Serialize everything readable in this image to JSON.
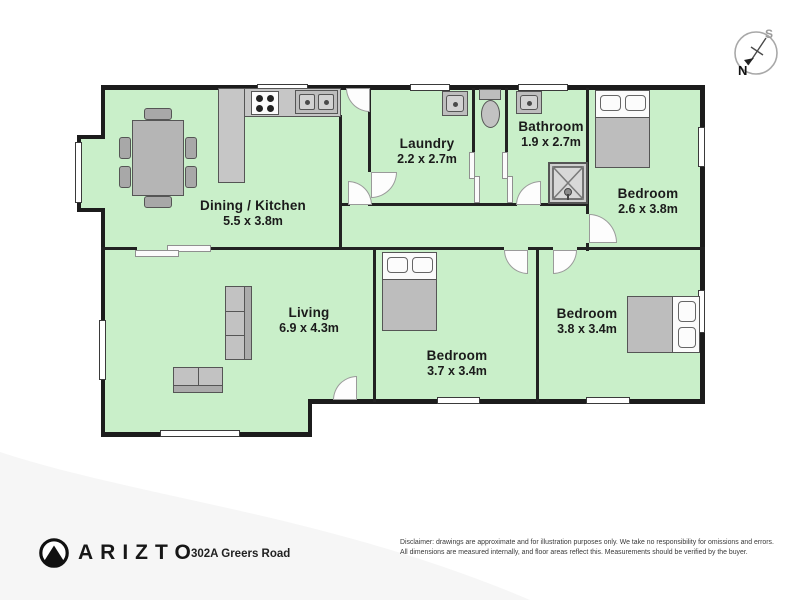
{
  "floorplan": {
    "rooms": [
      {
        "name": "Dining / Kitchen",
        "dims": "5.5 x 3.8m"
      },
      {
        "name": "Laundry",
        "dims": "2.2 x 2.7m"
      },
      {
        "name": "Bathroom",
        "dims": "1.9 x 2.7m"
      },
      {
        "name": "Bedroom",
        "dims": "2.6 x 3.8m"
      },
      {
        "name": "Living",
        "dims": "6.9 x 4.3m"
      },
      {
        "name": "Bedroom",
        "dims": "3.7 x 3.4m"
      },
      {
        "name": "Bedroom",
        "dims": "3.8 x 3.4m"
      }
    ],
    "compass": {
      "north": "N",
      "south": "S"
    },
    "colors": {
      "room_fill": "#c9efc9",
      "wall": "#1c1c1c",
      "furniture": "#bdbdbd"
    }
  },
  "footer": {
    "brand": "ARIZTO",
    "address": "302A Greers Road",
    "disclaimer_line1": "Disclaimer: drawings are approximate and for illustration purposes only. We take no responsibility for omissions and errors.",
    "disclaimer_line2": "All dimensions are measured internally, and floor areas reflect this. Measurements should be verified by the buyer."
  }
}
